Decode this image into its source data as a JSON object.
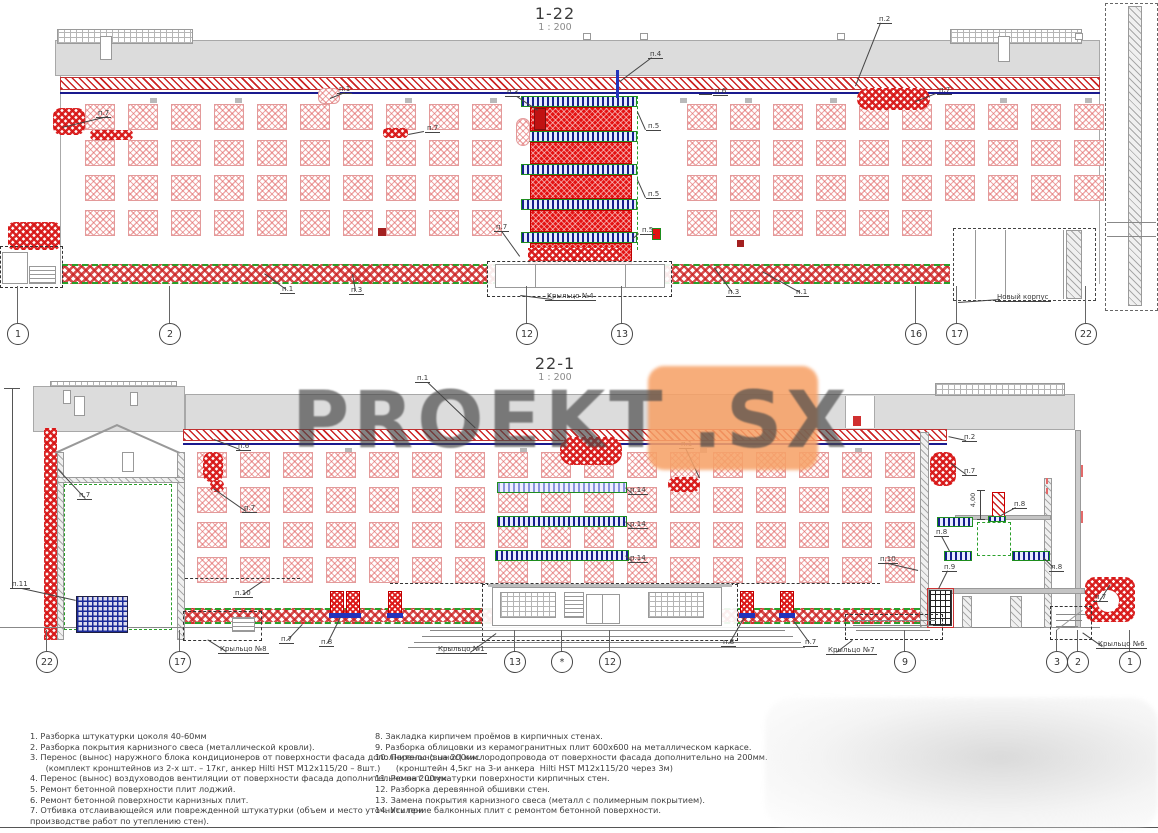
{
  "watermark": {
    "text": "PROEKT",
    "suffix": ".SX"
  },
  "colors": {
    "accent_red": "#d42020",
    "accent_blue": "#1a2a9a",
    "accent_green": "#2aa02a",
    "watermark_orange": "#f7a268",
    "parapet_gray": "#dcdcdc",
    "cornice_blue_line": "#1a1a8e"
  },
  "drawings": {
    "top": {
      "title": "1-22",
      "scale": "1 : 200",
      "axes": [
        {
          "label": "1",
          "x": 18
        },
        {
          "label": "2",
          "x": 170
        },
        {
          "label": "12",
          "x": 527
        },
        {
          "label": "13",
          "x": 622
        },
        {
          "label": "16",
          "x": 916
        },
        {
          "label": "17",
          "x": 957
        },
        {
          "label": "22",
          "x": 1086
        }
      ],
      "leaders": [
        {
          "t": "п.7",
          "x": 96,
          "y": 109,
          "line": [
            108,
            117,
            62,
            128
          ]
        },
        {
          "t": "п.1",
          "x": 337,
          "y": 85,
          "line": [
            345,
            93,
            330,
            99
          ]
        },
        {
          "t": "п.7",
          "x": 425,
          "y": 124,
          "line": [
            424,
            132,
            408,
            135
          ]
        },
        {
          "t": "п.3",
          "x": 505,
          "y": 88,
          "line": [
            517,
            96,
            538,
            110
          ]
        },
        {
          "t": "п.4",
          "x": 648,
          "y": 50,
          "line": [
            652,
            58,
            620,
            82
          ]
        },
        {
          "t": "п.5",
          "x": 646,
          "y": 122,
          "line": [
            645,
            130,
            637,
            112
          ]
        },
        {
          "t": "п.5",
          "x": 646,
          "y": 190,
          "line": [
            645,
            198,
            637,
            180
          ]
        },
        {
          "t": "п.5",
          "x": 640,
          "y": 226,
          "line": [
            639,
            234,
            633,
            239
          ]
        },
        {
          "t": "п.7",
          "x": 494,
          "y": 223,
          "line": [
            502,
            231,
            520,
            256
          ]
        },
        {
          "t": "п.2",
          "x": 877,
          "y": 15,
          "line": [
            881,
            23,
            856,
            86
          ]
        },
        {
          "t": "п.6",
          "x": 713,
          "y": 87,
          "line": [
            712,
            95,
            699,
            95
          ]
        },
        {
          "t": "п.7",
          "x": 937,
          "y": 86,
          "line": [
            936,
            94,
            916,
            102
          ]
        },
        {
          "t": "п.1",
          "x": 280,
          "y": 285,
          "line": [
            286,
            290,
            264,
            274
          ]
        },
        {
          "t": "п.3",
          "x": 349,
          "y": 286,
          "line": [
            355,
            291,
            352,
            274
          ]
        },
        {
          "t": "п.3",
          "x": 726,
          "y": 288,
          "line": [
            732,
            293,
            714,
            268
          ]
        },
        {
          "t": "п.1",
          "x": 794,
          "y": 288,
          "line": [
            800,
            293,
            762,
            272
          ]
        }
      ],
      "callouts": [
        {
          "text": "Крыльцо №4",
          "x": 545,
          "y": 292,
          "line": [
            552,
            300,
            520,
            296
          ]
        },
        {
          "text": "Новый корпус",
          "x": 995,
          "y": 293,
          "line": [
            1000,
            300,
            958,
            303
          ]
        }
      ]
    },
    "bottom": {
      "title": "22-1",
      "scale": "1 : 200",
      "dimension": "4,00",
      "axes": [
        {
          "label": "22",
          "x": 47
        },
        {
          "label": "17",
          "x": 180
        },
        {
          "label": "13",
          "x": 515
        },
        {
          "label": "*",
          "x": 562
        },
        {
          "label": "12",
          "x": 610
        },
        {
          "label": "9",
          "x": 905
        },
        {
          "label": "3",
          "x": 1057
        },
        {
          "label": "2",
          "x": 1078
        },
        {
          "label": "1",
          "x": 1130
        }
      ],
      "leaders": [
        {
          "t": "п.1",
          "x": 415,
          "y": 374,
          "line": [
            428,
            382,
            476,
            428
          ]
        },
        {
          "t": "п.6",
          "x": 236,
          "y": 442,
          "line": [
            240,
            450,
            214,
            440
          ]
        },
        {
          "t": "п.7",
          "x": 77,
          "y": 491,
          "line": [
            85,
            499,
            58,
            470
          ]
        },
        {
          "t": "п.7",
          "x": 242,
          "y": 504,
          "line": [
            246,
            512,
            213,
            489
          ]
        },
        {
          "t": "п.1",
          "x": 679,
          "y": 440,
          "line": [
            686,
            448,
            700,
            478
          ]
        },
        {
          "t": "п.2",
          "x": 962,
          "y": 433,
          "line": [
            966,
            441,
            948,
            437
          ]
        },
        {
          "t": "п.7",
          "x": 962,
          "y": 467,
          "line": [
            966,
            475,
            951,
            464
          ]
        },
        {
          "t": "п.14",
          "x": 628,
          "y": 486,
          "line": [
            632,
            494,
            625,
            488
          ]
        },
        {
          "t": "п.14",
          "x": 628,
          "y": 520,
          "line": [
            632,
            528,
            625,
            522
          ]
        },
        {
          "t": "п.14",
          "x": 628,
          "y": 554,
          "line": [
            632,
            562,
            625,
            556
          ]
        },
        {
          "t": "п.8",
          "x": 934,
          "y": 528,
          "line": [
            942,
            536,
            950,
            551
          ]
        },
        {
          "t": "п.8",
          "x": 1012,
          "y": 500,
          "line": [
            1016,
            508,
            1001,
            516
          ]
        },
        {
          "t": "п.8",
          "x": 1049,
          "y": 563,
          "line": [
            1053,
            568,
            1043,
            558
          ]
        },
        {
          "t": "п.9",
          "x": 942,
          "y": 563,
          "line": [
            948,
            571,
            939,
            589
          ]
        },
        {
          "t": "п.10",
          "x": 233,
          "y": 589,
          "line": [
            243,
            594,
            262,
            581
          ]
        },
        {
          "t": "п.10",
          "x": 878,
          "y": 555,
          "line": [
            888,
            563,
            918,
            570
          ]
        },
        {
          "t": "п.11",
          "x": 10,
          "y": 580,
          "line": [
            22,
            588,
            76,
            600
          ]
        },
        {
          "t": "п.7",
          "x": 279,
          "y": 635,
          "line": [
            287,
            640,
            302,
            624
          ]
        },
        {
          "t": "п.8",
          "x": 319,
          "y": 638,
          "line": [
            327,
            643,
            340,
            617
          ]
        },
        {
          "t": "п.8",
          "x": 721,
          "y": 638,
          "line": [
            729,
            643,
            744,
            617
          ]
        },
        {
          "t": "п.7",
          "x": 803,
          "y": 638,
          "line": [
            809,
            643,
            793,
            621
          ]
        },
        {
          "t": "п.7",
          "x": 1093,
          "y": 593,
          "line": [
            1099,
            601,
            1110,
            584
          ]
        }
      ],
      "callouts": [
        {
          "text": "Крыльцо №8",
          "x": 218,
          "y": 645,
          "line": [
            226,
            652,
            207,
            640
          ]
        },
        {
          "text": "Крыльцо №1",
          "x": 436,
          "y": 645,
          "line": [
            470,
            652,
            496,
            633
          ]
        },
        {
          "text": "Крыльцо №7",
          "x": 826,
          "y": 646,
          "line": [
            836,
            652,
            852,
            640
          ]
        },
        {
          "text": "Крыльцо №6",
          "x": 1096,
          "y": 640,
          "line": [
            1102,
            647,
            1082,
            633
          ]
        }
      ]
    }
  },
  "notes": {
    "left": [
      "1. Разборка штукатурки цоколя 40-60мм",
      "2. Разборка покрытия карнизного свеса (металлической кровли).",
      "3. Перенос (вынос) наружного блока кондиционеров от поверхности фасада дополнительно на 200мм.",
      "      (комплект кронштейнов из 2-х шт. – 17кг, анкер Hilti HST M12x115/20 – 8шт.)",
      "4. Перенос (вынос) воздуховодов вентиляции от поверхности фасада дополнительно на 200мм.",
      "5. Ремонт бетонной поверхности плит лоджий.",
      "6. Ремонт бетонной поверхности карнизных плит.",
      "7. Отбивка отслаивающейся или поврежденной штукатурки (объем и место уточнить при",
      "производстве работ по утеплению стен)."
    ],
    "right": [
      "8. Закладка кирпичем проёмов в кирпичных стенах.",
      "9. Разборка облицовки из керамогранитных плит 600х600 на металлическом каркасе.",
      "10. Перенос (вынос) кислородопровода от поверхности фасада дополнительно на 200мм.",
      "        (кронштейн 4,5кг на 3-и анкера  Hilti HST M12x115/20 через 3м)",
      "11. Ремонт штукатурки поверхности кирпичных стен.",
      "12. Разборка деревянной обшивки стен.",
      "13. Замена покрытия карнизного свеса (металл с полимерным покрытием).",
      "14. Усиление балконных плит с ремонтом бетонной поверхности."
    ]
  }
}
